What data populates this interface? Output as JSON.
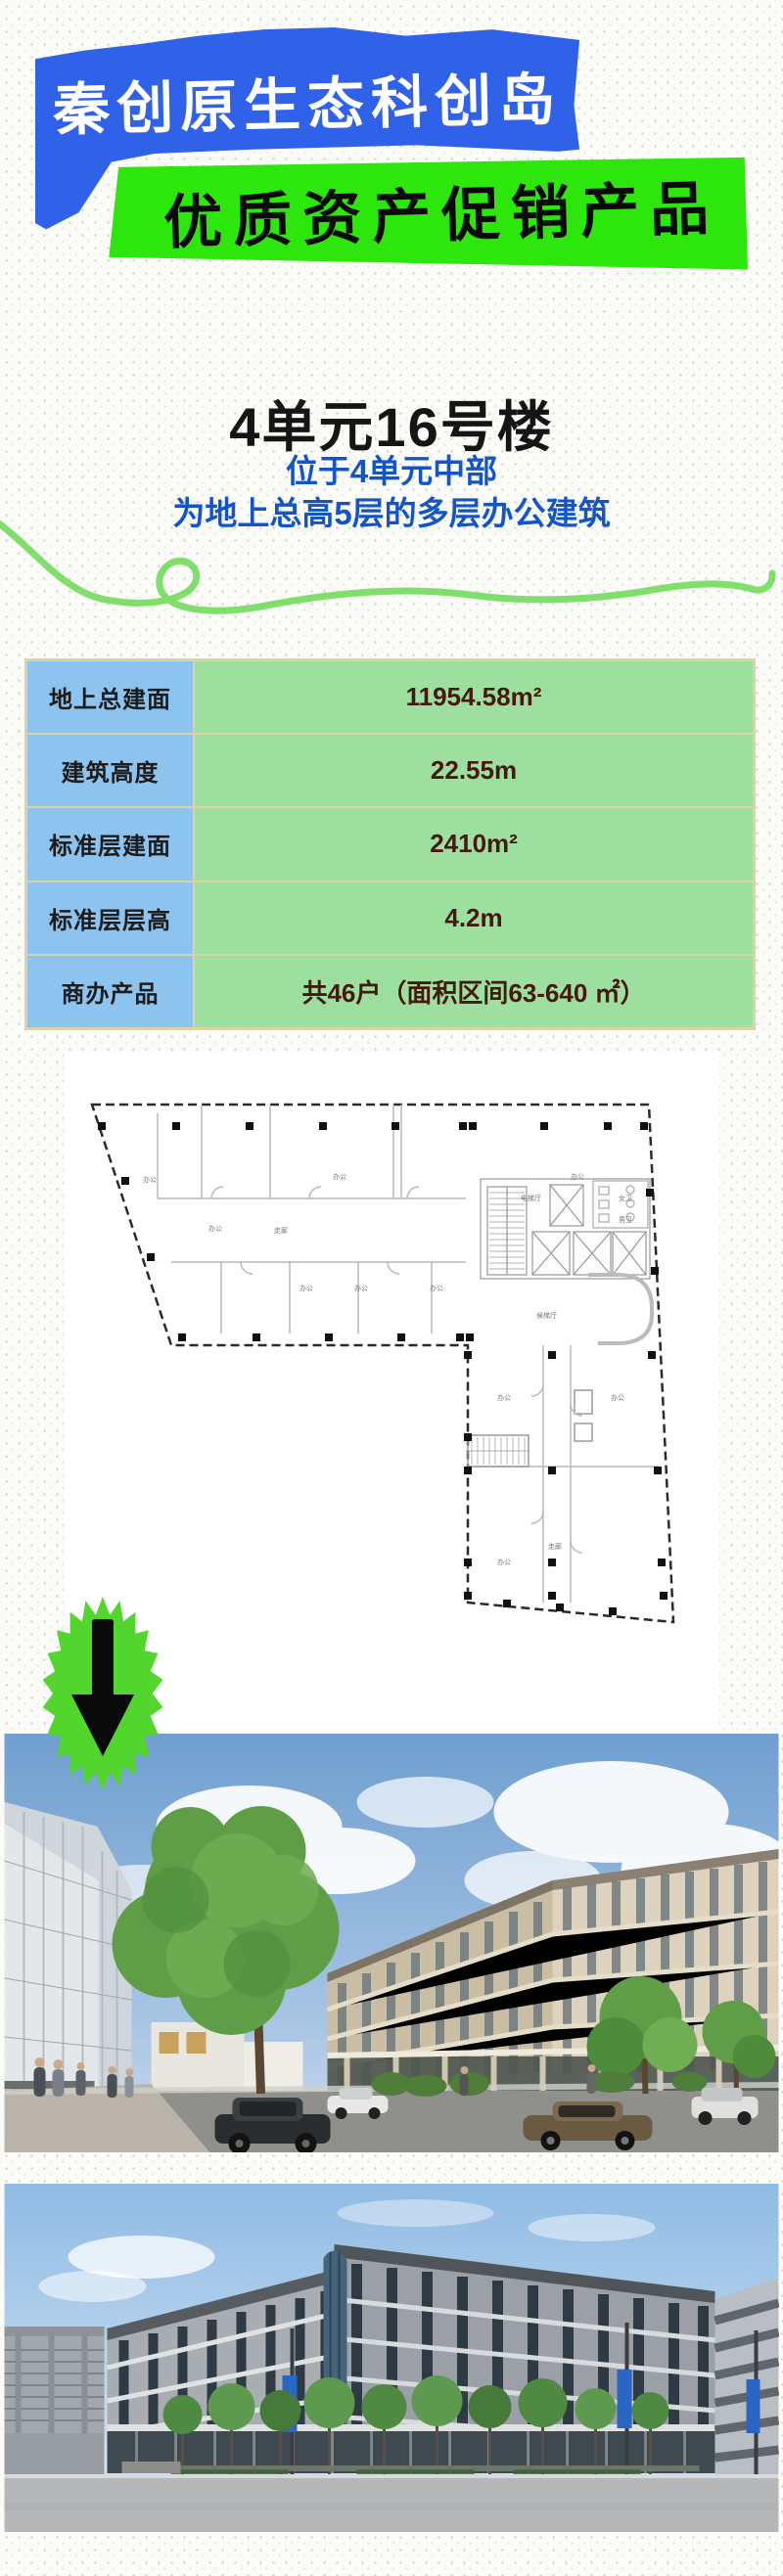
{
  "header": {
    "banner_primary": {
      "text": "秦创原生态科创岛",
      "bg_color": "#2f62e8",
      "text_color": "#ffffff"
    },
    "banner_secondary": {
      "text": "优质资产促销产品",
      "bg_color": "#2de60c",
      "text_color": "#0a0a0a"
    }
  },
  "building": {
    "title": "4单元16号楼",
    "subtitle_line1": "位于4单元中部",
    "subtitle_line2": "为地上总高5层的多层办公建筑",
    "subtitle_color": "#1155c8"
  },
  "specs": {
    "rows": [
      {
        "label": "地上总建面",
        "value": "11954.58m²"
      },
      {
        "label": "建筑高度",
        "value": "22.55m"
      },
      {
        "label": "标准层建面",
        "value": "2410m²"
      },
      {
        "label": "标准层层高",
        "value": "4.2m"
      },
      {
        "label": "商办产品",
        "value": "共46户（面积区间63-640 ㎡）"
      }
    ],
    "label_bg_color": "#8cc3ef",
    "value_bg_color": "#9cdf9e",
    "border_color": "#ddd3a2",
    "value_text_color": "#47180f"
  },
  "floor_plan": {
    "labels": {
      "office": "办公",
      "corridor": "走廊",
      "elevator_hall": "电梯厅",
      "waiting_hall": "候梯厅",
      "womens_wc": "女卫",
      "mens_wc": "男卫"
    }
  },
  "decor": {
    "squiggle_color": "#7fdf6a",
    "starburst_color": "#52d62e",
    "arrow_color": "#0a0a0a",
    "background_dot_color": "#d7d7d4"
  }
}
